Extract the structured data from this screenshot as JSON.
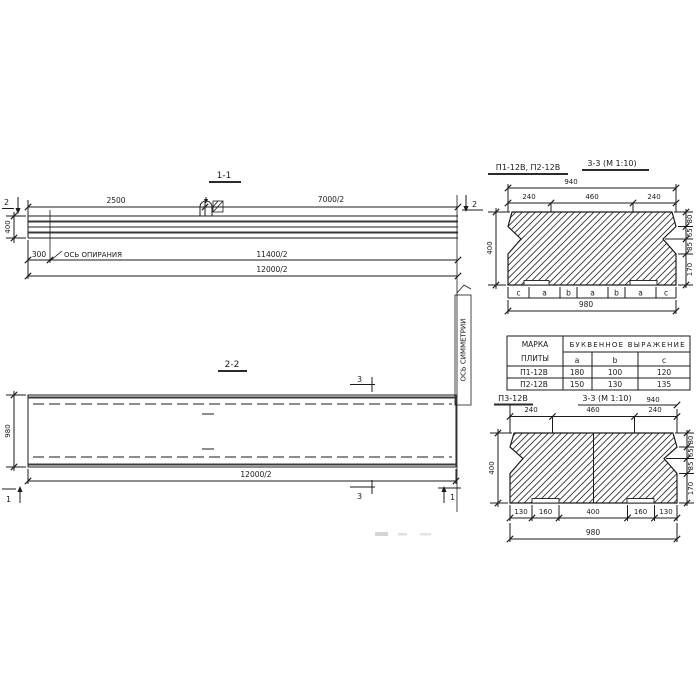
{
  "section_1_1": {
    "title": "1-1",
    "cut_mark_left": "2",
    "cut_mark_right": "2",
    "dim_2500": "2500",
    "dim_7000_2": "7000/2",
    "dim_height": "400",
    "dim_300": "300",
    "support_axis_label": "ОСЬ ОПИРАНИЯ",
    "dim_11400_2": "11400/2",
    "dim_12000_2": "12000/2"
  },
  "section_2_2": {
    "title": "2-2",
    "dim_height": "980",
    "dim_12000_2": "12000/2",
    "cut_mark_3_top": "3",
    "cut_mark_3_bottom": "3",
    "cut_mark_1_left": "1",
    "cut_mark_1_right": "1"
  },
  "symmetry_axis_label": "ОСЬ СИММЕТРИИ",
  "section_3_3_top": {
    "label": "П1-12В, П2-12В",
    "title": "3-3 (М 1:10)",
    "dim_top_total": "940",
    "dim_top": [
      "240",
      "460",
      "240"
    ],
    "dim_height": "400",
    "dims_right": [
      "80",
      "65",
      "85",
      "170"
    ],
    "letters": [
      "c",
      "a",
      "b",
      "a",
      "b",
      "a",
      "c"
    ],
    "dim_bottom_total": "980"
  },
  "table": {
    "header_col1_line1": "МАРКА",
    "header_col1_line2": "ПЛИТЫ",
    "header_group": "БУКВЕННОЕ  ВЫРАЖЕНИЕ",
    "col_a": "a",
    "col_b": "b",
    "col_c": "c",
    "rows": [
      {
        "mark": "П1-12В",
        "a": "180",
        "b": "100",
        "c": "120"
      },
      {
        "mark": "П2-12В",
        "a": "150",
        "b": "130",
        "c": "135"
      }
    ]
  },
  "section_3_3_bottom": {
    "label": "П3-12В",
    "title": "3-3 (М 1:10)",
    "dim_top_total": "940",
    "dim_top": [
      "240",
      "460",
      "240"
    ],
    "dim_height": "400",
    "dims_right": [
      "80",
      "65",
      "85",
      "170"
    ],
    "dims_bottom": [
      "130",
      "160",
      "400",
      "160",
      "130"
    ],
    "dim_bottom_total": "980"
  }
}
